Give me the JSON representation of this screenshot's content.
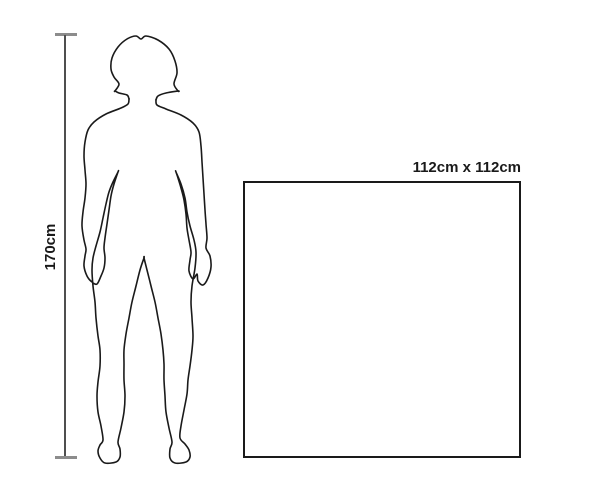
{
  "diagram": {
    "type": "size-comparison",
    "person": {
      "description": "outline silhouette of a standing woman",
      "height_label": "170cm"
    },
    "item": {
      "shape": "square",
      "size_label": "112cm x 112cm"
    },
    "colors": {
      "background": "#ffffff",
      "outline": "#1a1a1a",
      "dimension_line": "#4f4f4f",
      "dimension_cap": "#8c8c8c"
    }
  }
}
